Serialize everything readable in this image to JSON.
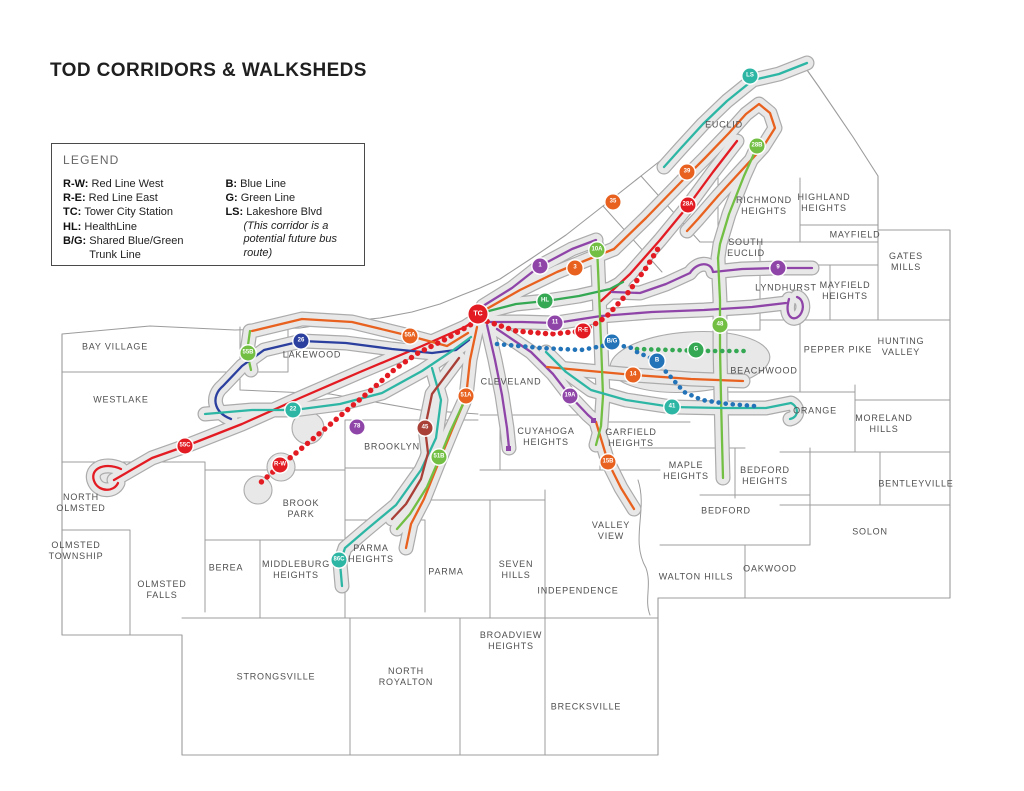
{
  "title": "TOD CORRIDORS & WALKSHEDS",
  "legend": {
    "heading": "LEGEND",
    "left": [
      {
        "key": "R-W:",
        "label": "Red Line West"
      },
      {
        "key": "R-E:",
        "label": "Red Line East"
      },
      {
        "key": "TC:",
        "label": "Tower City Station"
      },
      {
        "key": "HL:",
        "label": "HealthLine"
      },
      {
        "key": "B/G:",
        "label": "Shared Blue/Green\nTrunk Line"
      }
    ],
    "right": [
      {
        "key": "B:",
        "label": "Blue Line"
      },
      {
        "key": "G:",
        "label": "Green Line"
      },
      {
        "key": "LS:",
        "label": "Lakeshore Blvd",
        "note": "(This corridor is a potential future bus route)"
      }
    ]
  },
  "colors": {
    "red": "#e31b23",
    "darkred": "#a94038",
    "orange": "#e8611f",
    "lgreen": "#72bf44",
    "green": "#35a854",
    "teal": "#2eb6a5",
    "navy": "#2b3f9f",
    "blue": "#2273b8",
    "purple": "#8f45a8",
    "walkshed": "#e8e8e8",
    "casing": "#ababab",
    "boundary": "#9c9c9c",
    "label": "#4f4f4f",
    "title": "#1f1f1f"
  },
  "map": {
    "labels": [
      {
        "text": "BAY VILLAGE",
        "x": 115,
        "y": 347
      },
      {
        "text": "WESTLAKE",
        "x": 121,
        "y": 400
      },
      {
        "text": "NORTH\nOLMSTED",
        "x": 81,
        "y": 503
      },
      {
        "text": "OLMSTED\nTOWNSHIP",
        "x": 76,
        "y": 551
      },
      {
        "text": "OLMSTED\nFALLS",
        "x": 162,
        "y": 590
      },
      {
        "text": "BEREA",
        "x": 226,
        "y": 568
      },
      {
        "text": "MIDDLEBURG\nHEIGHTS",
        "x": 296,
        "y": 570
      },
      {
        "text": "BROOK\nPARK",
        "x": 301,
        "y": 509
      },
      {
        "text": "LAKEWOOD",
        "x": 312,
        "y": 355
      },
      {
        "text": "CLEVELAND",
        "x": 511,
        "y": 382
      },
      {
        "text": "BROOKLYN",
        "x": 392,
        "y": 447
      },
      {
        "text": "PARMA\nHEIGHTS",
        "x": 371,
        "y": 554
      },
      {
        "text": "PARMA",
        "x": 446,
        "y": 572
      },
      {
        "text": "STRONGSVILLE",
        "x": 276,
        "y": 677
      },
      {
        "text": "NORTH\nROYALTON",
        "x": 406,
        "y": 677
      },
      {
        "text": "BROADVIEW\nHEIGHTS",
        "x": 511,
        "y": 641
      },
      {
        "text": "BRECKSVILLE",
        "x": 586,
        "y": 707
      },
      {
        "text": "SEVEN\nHILLS",
        "x": 516,
        "y": 570
      },
      {
        "text": "INDEPENDENCE",
        "x": 578,
        "y": 591
      },
      {
        "text": "CUYAHOGA\nHEIGHTS",
        "x": 546,
        "y": 437
      },
      {
        "text": "VALLEY\nVIEW",
        "x": 611,
        "y": 531
      },
      {
        "text": "GARFIELD\nHEIGHTS",
        "x": 631,
        "y": 438
      },
      {
        "text": "MAPLE\nHEIGHTS",
        "x": 686,
        "y": 471
      },
      {
        "text": "BEDFORD",
        "x": 726,
        "y": 511
      },
      {
        "text": "BEDFORD\nHEIGHTS",
        "x": 765,
        "y": 476
      },
      {
        "text": "WALTON HILLS",
        "x": 696,
        "y": 577
      },
      {
        "text": "OAKWOOD",
        "x": 770,
        "y": 569
      },
      {
        "text": "SOLON",
        "x": 870,
        "y": 532
      },
      {
        "text": "BENTLEYVILLE",
        "x": 916,
        "y": 484
      },
      {
        "text": "MORELAND\nHILLS",
        "x": 884,
        "y": 424
      },
      {
        "text": "ORANGE",
        "x": 815,
        "y": 411
      },
      {
        "text": "PEPPER PIKE",
        "x": 838,
        "y": 350
      },
      {
        "text": "HUNTING\nVALLEY",
        "x": 901,
        "y": 347
      },
      {
        "text": "BEACHWOOD",
        "x": 764,
        "y": 371
      },
      {
        "text": "LYNDHURST",
        "x": 786,
        "y": 288
      },
      {
        "text": "MAYFIELD\nHEIGHTS",
        "x": 845,
        "y": 291
      },
      {
        "text": "GATES\nMILLS",
        "x": 906,
        "y": 262
      },
      {
        "text": "MAYFIELD",
        "x": 855,
        "y": 235
      },
      {
        "text": "HIGHLAND\nHEIGHTS",
        "x": 824,
        "y": 203
      },
      {
        "text": "RICHMOND\nHEIGHTS",
        "x": 764,
        "y": 206
      },
      {
        "text": "SOUTH\nEUCLID",
        "x": 746,
        "y": 248
      },
      {
        "text": "EUCLID",
        "x": 724,
        "y": 125
      }
    ],
    "badges": [
      {
        "text": "LS",
        "color": "teal",
        "x": 750,
        "y": 76
      },
      {
        "text": "39",
        "color": "orange",
        "x": 687,
        "y": 172
      },
      {
        "text": "28B",
        "color": "lgreen",
        "x": 757,
        "y": 146
      },
      {
        "text": "28A",
        "color": "red",
        "x": 688,
        "y": 205
      },
      {
        "text": "35",
        "color": "orange",
        "x": 613,
        "y": 202
      },
      {
        "text": "1",
        "color": "purple",
        "x": 540,
        "y": 266
      },
      {
        "text": "3",
        "color": "orange",
        "x": 575,
        "y": 268
      },
      {
        "text": "10A",
        "color": "lgreen",
        "x": 597,
        "y": 250
      },
      {
        "text": "HL",
        "color": "green",
        "x": 545,
        "y": 301
      },
      {
        "text": "11",
        "color": "purple",
        "x": 555,
        "y": 323
      },
      {
        "text": "TC",
        "color": "red",
        "x": 478,
        "y": 314,
        "big": true
      },
      {
        "text": "R-E",
        "color": "red",
        "x": 583,
        "y": 331
      },
      {
        "text": "B/G",
        "color": "blue",
        "x": 612,
        "y": 342
      },
      {
        "text": "B",
        "color": "blue",
        "x": 657,
        "y": 361
      },
      {
        "text": "G",
        "color": "green",
        "x": 696,
        "y": 350
      },
      {
        "text": "9",
        "color": "purple",
        "x": 778,
        "y": 268
      },
      {
        "text": "48",
        "color": "lgreen",
        "x": 720,
        "y": 325
      },
      {
        "text": "14",
        "color": "orange",
        "x": 633,
        "y": 375
      },
      {
        "text": "41",
        "color": "teal",
        "x": 672,
        "y": 407
      },
      {
        "text": "19A",
        "color": "purple",
        "x": 570,
        "y": 396
      },
      {
        "text": "15B",
        "color": "orange",
        "x": 608,
        "y": 462
      },
      {
        "text": "51A",
        "color": "orange",
        "x": 466,
        "y": 396
      },
      {
        "text": "45",
        "color": "darkred",
        "x": 425,
        "y": 428
      },
      {
        "text": "51B",
        "color": "lgreen",
        "x": 439,
        "y": 457
      },
      {
        "text": "86C",
        "color": "teal",
        "x": 339,
        "y": 560
      },
      {
        "text": "55A",
        "color": "orange",
        "x": 410,
        "y": 336
      },
      {
        "text": "26",
        "color": "navy",
        "x": 301,
        "y": 341
      },
      {
        "text": "55B",
        "color": "lgreen",
        "x": 248,
        "y": 353
      },
      {
        "text": "22",
        "color": "teal",
        "x": 293,
        "y": 410
      },
      {
        "text": "78",
        "color": "purple",
        "x": 357,
        "y": 427
      },
      {
        "text": "55C",
        "color": "red",
        "x": 185,
        "y": 446
      },
      {
        "text": "R-W",
        "color": "red",
        "x": 280,
        "y": 465
      }
    ]
  }
}
